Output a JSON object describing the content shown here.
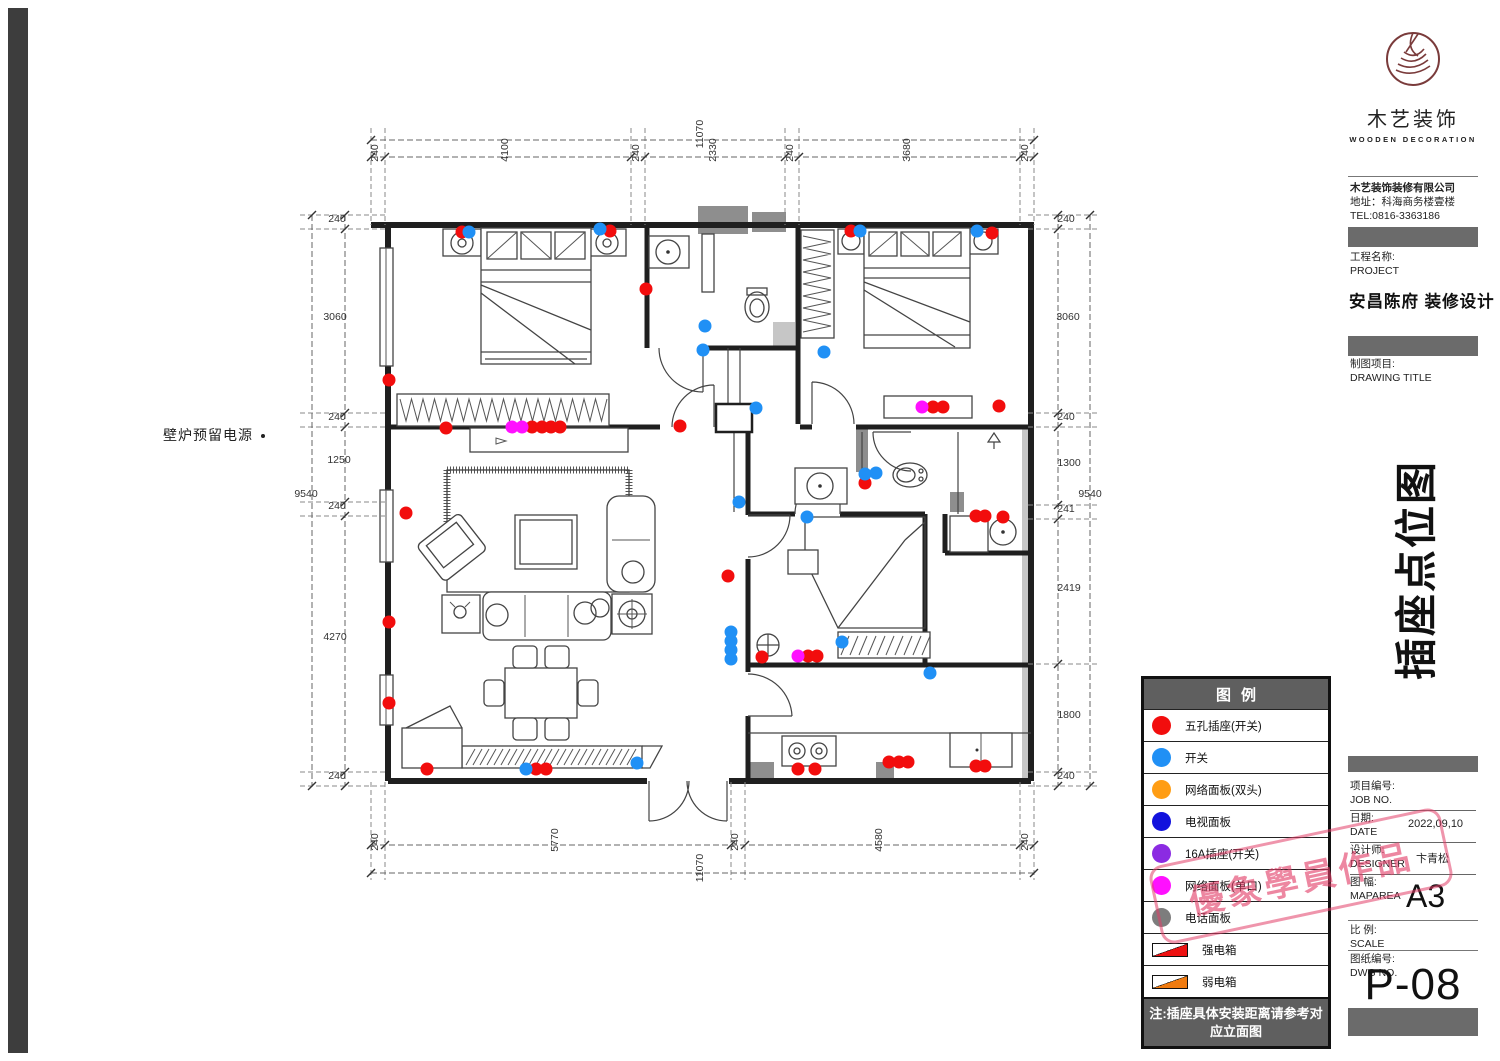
{
  "annotation": {
    "fireplace_power": "壁炉预留电源"
  },
  "plan": {
    "socket_colors": {
      "r": "#f20d0d",
      "b": "#2090f5",
      "m": "#ff10ff"
    },
    "sockets": [
      [
        462,
        232,
        "r"
      ],
      [
        610,
        231,
        "r"
      ],
      [
        646,
        289,
        "r"
      ],
      [
        389,
        380,
        "r"
      ],
      [
        446,
        428,
        "r"
      ],
      [
        532,
        427,
        "r"
      ],
      [
        542,
        427,
        "r"
      ],
      [
        551,
        427,
        "r"
      ],
      [
        560,
        427,
        "r"
      ],
      [
        680,
        426,
        "r"
      ],
      [
        851,
        231,
        "r"
      ],
      [
        992,
        233,
        "r"
      ],
      [
        933,
        407,
        "r"
      ],
      [
        943,
        407,
        "r"
      ],
      [
        999,
        406,
        "r"
      ],
      [
        406,
        513,
        "r"
      ],
      [
        389,
        622,
        "r"
      ],
      [
        389,
        703,
        "r"
      ],
      [
        427,
        769,
        "r"
      ],
      [
        536,
        769,
        "r"
      ],
      [
        546,
        769,
        "r"
      ],
      [
        728,
        576,
        "r"
      ],
      [
        865,
        483,
        "r"
      ],
      [
        976,
        516,
        "r"
      ],
      [
        985,
        516,
        "r"
      ],
      [
        1003,
        517,
        "r"
      ],
      [
        762,
        657,
        "r"
      ],
      [
        808,
        656,
        "r"
      ],
      [
        817,
        656,
        "r"
      ],
      [
        798,
        769,
        "r"
      ],
      [
        815,
        769,
        "r"
      ],
      [
        889,
        762,
        "r"
      ],
      [
        899,
        762,
        "r"
      ],
      [
        908,
        762,
        "r"
      ],
      [
        976,
        766,
        "r"
      ],
      [
        985,
        766,
        "r"
      ],
      [
        469,
        232,
        "b"
      ],
      [
        600,
        229,
        "b"
      ],
      [
        705,
        326,
        "b"
      ],
      [
        703,
        350,
        "b"
      ],
      [
        756,
        408,
        "b"
      ],
      [
        824,
        352,
        "b"
      ],
      [
        860,
        231,
        "b"
      ],
      [
        977,
        231,
        "b"
      ],
      [
        739,
        502,
        "b"
      ],
      [
        731,
        632,
        "b"
      ],
      [
        731,
        641,
        "b"
      ],
      [
        731,
        650,
        "b"
      ],
      [
        731,
        659,
        "b"
      ],
      [
        526,
        769,
        "b"
      ],
      [
        637,
        763,
        "b"
      ],
      [
        865,
        474,
        "b"
      ],
      [
        876,
        473,
        "b"
      ],
      [
        807,
        517,
        "b"
      ],
      [
        842,
        642,
        "b"
      ],
      [
        930,
        673,
        "b"
      ],
      [
        512,
        427,
        "m"
      ],
      [
        522,
        427,
        "m"
      ],
      [
        922,
        407,
        "m"
      ],
      [
        798,
        656,
        "m"
      ]
    ],
    "dim_labels": [
      {
        "t": "11070",
        "x": 703,
        "y": 134,
        "v": true
      },
      {
        "t": "240",
        "x": 378,
        "y": 153,
        "v": true
      },
      {
        "t": "4100",
        "x": 508,
        "y": 150,
        "v": true
      },
      {
        "t": "240",
        "x": 639,
        "y": 153,
        "v": true
      },
      {
        "t": "2330",
        "x": 716,
        "y": 150,
        "v": true
      },
      {
        "t": "240",
        "x": 793,
        "y": 153,
        "v": true
      },
      {
        "t": "3680",
        "x": 910,
        "y": 150,
        "v": true
      },
      {
        "t": "240",
        "x": 1028,
        "y": 153,
        "v": true
      },
      {
        "t": "240",
        "x": 378,
        "y": 842,
        "v": true
      },
      {
        "t": "5770",
        "x": 558,
        "y": 840,
        "v": true
      },
      {
        "t": "240",
        "x": 738,
        "y": 842,
        "v": true
      },
      {
        "t": "4580",
        "x": 882,
        "y": 840,
        "v": true
      },
      {
        "t": "240",
        "x": 1028,
        "y": 842,
        "v": true
      },
      {
        "t": "11070",
        "x": 703,
        "y": 868,
        "v": true
      },
      {
        "t": "240",
        "x": 337,
        "y": 222,
        "v": false
      },
      {
        "t": "3060",
        "x": 335,
        "y": 320,
        "v": false
      },
      {
        "t": "240",
        "x": 337,
        "y": 420,
        "v": false
      },
      {
        "t": "1250",
        "x": 339,
        "y": 463,
        "v": false
      },
      {
        "t": "240",
        "x": 337,
        "y": 509,
        "v": false
      },
      {
        "t": "4270",
        "x": 335,
        "y": 640,
        "v": false
      },
      {
        "t": "240",
        "x": 337,
        "y": 779,
        "v": false
      },
      {
        "t": "9540",
        "x": 306,
        "y": 497,
        "v": false
      },
      {
        "t": "240",
        "x": 1066,
        "y": 222,
        "v": false
      },
      {
        "t": "3060",
        "x": 1068,
        "y": 320,
        "v": false
      },
      {
        "t": "240",
        "x": 1066,
        "y": 420,
        "v": false
      },
      {
        "t": "1300",
        "x": 1069,
        "y": 466,
        "v": false
      },
      {
        "t": "241",
        "x": 1066,
        "y": 512,
        "v": false
      },
      {
        "t": "2419",
        "x": 1069,
        "y": 591,
        "v": false
      },
      {
        "t": "1800",
        "x": 1069,
        "y": 718,
        "v": false
      },
      {
        "t": "240",
        "x": 1066,
        "y": 779,
        "v": false
      },
      {
        "t": "9540",
        "x": 1090,
        "y": 497,
        "v": false
      }
    ],
    "dim_lines": [
      [
        371,
        140,
        1034,
        140
      ],
      [
        371,
        157,
        1034,
        157
      ],
      [
        371,
        845,
        1034,
        845
      ],
      [
        371,
        873,
        1034,
        873
      ],
      [
        345,
        215,
        345,
        786
      ],
      [
        312,
        215,
        312,
        786
      ],
      [
        1058,
        215,
        1058,
        786
      ],
      [
        1090,
        215,
        1090,
        786
      ]
    ],
    "ext_lines": [
      [
        371,
        128,
        371,
        225
      ],
      [
        385,
        128,
        385,
        225
      ],
      [
        631,
        128,
        631,
        225
      ],
      [
        645,
        128,
        645,
        225
      ],
      [
        785,
        128,
        785,
        225
      ],
      [
        799,
        128,
        799,
        225
      ],
      [
        1020,
        128,
        1020,
        225
      ],
      [
        1034,
        128,
        1034,
        225
      ],
      [
        371,
        782,
        371,
        880
      ],
      [
        385,
        782,
        385,
        880
      ],
      [
        731,
        782,
        731,
        880
      ],
      [
        745,
        782,
        745,
        880
      ],
      [
        1020,
        782,
        1020,
        880
      ],
      [
        1034,
        782,
        1034,
        880
      ],
      [
        300,
        215,
        388,
        215
      ],
      [
        300,
        229,
        388,
        229
      ],
      [
        300,
        413,
        388,
        413
      ],
      [
        300,
        427,
        388,
        427
      ],
      [
        300,
        502,
        388,
        502
      ],
      [
        300,
        516,
        388,
        516
      ],
      [
        300,
        772,
        388,
        772
      ],
      [
        300,
        786,
        388,
        786
      ],
      [
        1028,
        215,
        1098,
        215
      ],
      [
        1028,
        229,
        1098,
        229
      ],
      [
        1028,
        413,
        1098,
        413
      ],
      [
        1028,
        427,
        1098,
        427
      ],
      [
        1028,
        505,
        1098,
        505
      ],
      [
        1028,
        519,
        1098,
        519
      ],
      [
        1028,
        664,
        1098,
        664
      ],
      [
        1028,
        772,
        1098,
        772
      ],
      [
        1028,
        786,
        1098,
        786
      ]
    ],
    "ticks": [
      [
        371,
        157
      ],
      [
        385,
        157
      ],
      [
        631,
        157
      ],
      [
        645,
        157
      ],
      [
        785,
        157
      ],
      [
        799,
        157
      ],
      [
        1020,
        157
      ],
      [
        1034,
        157
      ],
      [
        371,
        140
      ],
      [
        1034,
        140
      ],
      [
        371,
        845
      ],
      [
        385,
        845
      ],
      [
        731,
        845
      ],
      [
        745,
        845
      ],
      [
        1020,
        845
      ],
      [
        1034,
        845
      ],
      [
        371,
        873
      ],
      [
        1034,
        873
      ],
      [
        345,
        215
      ],
      [
        345,
        229
      ],
      [
        345,
        413
      ],
      [
        345,
        427
      ],
      [
        345,
        502
      ],
      [
        345,
        516
      ],
      [
        345,
        772
      ],
      [
        345,
        786
      ],
      [
        312,
        215
      ],
      [
        312,
        786
      ],
      [
        1058,
        215
      ],
      [
        1058,
        229
      ],
      [
        1058,
        413
      ],
      [
        1058,
        427
      ],
      [
        1058,
        505
      ],
      [
        1058,
        519
      ],
      [
        1058,
        664
      ],
      [
        1058,
        772
      ],
      [
        1058,
        786
      ],
      [
        1090,
        215
      ],
      [
        1090,
        786
      ]
    ]
  },
  "legend": {
    "title": "图例",
    "items": [
      {
        "shape": "circle",
        "color": "#f20d0d",
        "label": "五孔插座(开关)"
      },
      {
        "shape": "circle",
        "color": "#2090f5",
        "label": "开关"
      },
      {
        "shape": "circle",
        "color": "#ff9d14",
        "label": "网络面板(双头)"
      },
      {
        "shape": "circle",
        "color": "#1212dd",
        "label": "电视面板"
      },
      {
        "shape": "circle",
        "color": "#8b2be2",
        "label": "16A插座(开关)"
      },
      {
        "shape": "circle",
        "color": "#ff10ff",
        "label": "网络面板(单口)"
      },
      {
        "shape": "circle",
        "color": "#7d7d7d",
        "label": "电话面板"
      },
      {
        "shape": "box",
        "color": "#ee1111",
        "label": "强电箱"
      },
      {
        "shape": "box",
        "color": "#f07b10",
        "label": "弱电箱"
      }
    ],
    "note": "注:插座具体安装距离请参考对应立面图"
  },
  "title_block": {
    "logo": {
      "brand": "木艺装饰",
      "brand_en": "WOODEN DECORATION"
    },
    "company": {
      "lines": [
        "木艺装饰装修有限公司",
        "地址：科海商务楼壹楼",
        "TEL:0816-3363186",
        "18781691118"
      ]
    },
    "project_label": "工程名称:",
    "project_label_en": "PROJECT",
    "project_name": "安昌陈府 装修设计",
    "drawing_label": "制图项目:",
    "drawing_label_en": "DRAWING TITLE",
    "drawing_title": "插座点位图",
    "job_label": "项目编号:",
    "job_label_en": "JOB NO.",
    "date_label": "日期:",
    "date_label_en": "DATE",
    "date_value": "2022,09,10",
    "designer_label": "设计师:",
    "designer_label_en": "DESIGNER",
    "designer_value": "卞青松",
    "maparea_label": "图 幅:",
    "maparea_label_en": "MAPAREA",
    "maparea_value": "A3",
    "scale_label": "比 例:",
    "scale_label_en": "SCALE",
    "dwg_label": "图纸编号:",
    "dwg_label_en": "DWG NO.",
    "page_number": "P-08"
  },
  "stamp": {
    "text": "優象學員作品"
  }
}
